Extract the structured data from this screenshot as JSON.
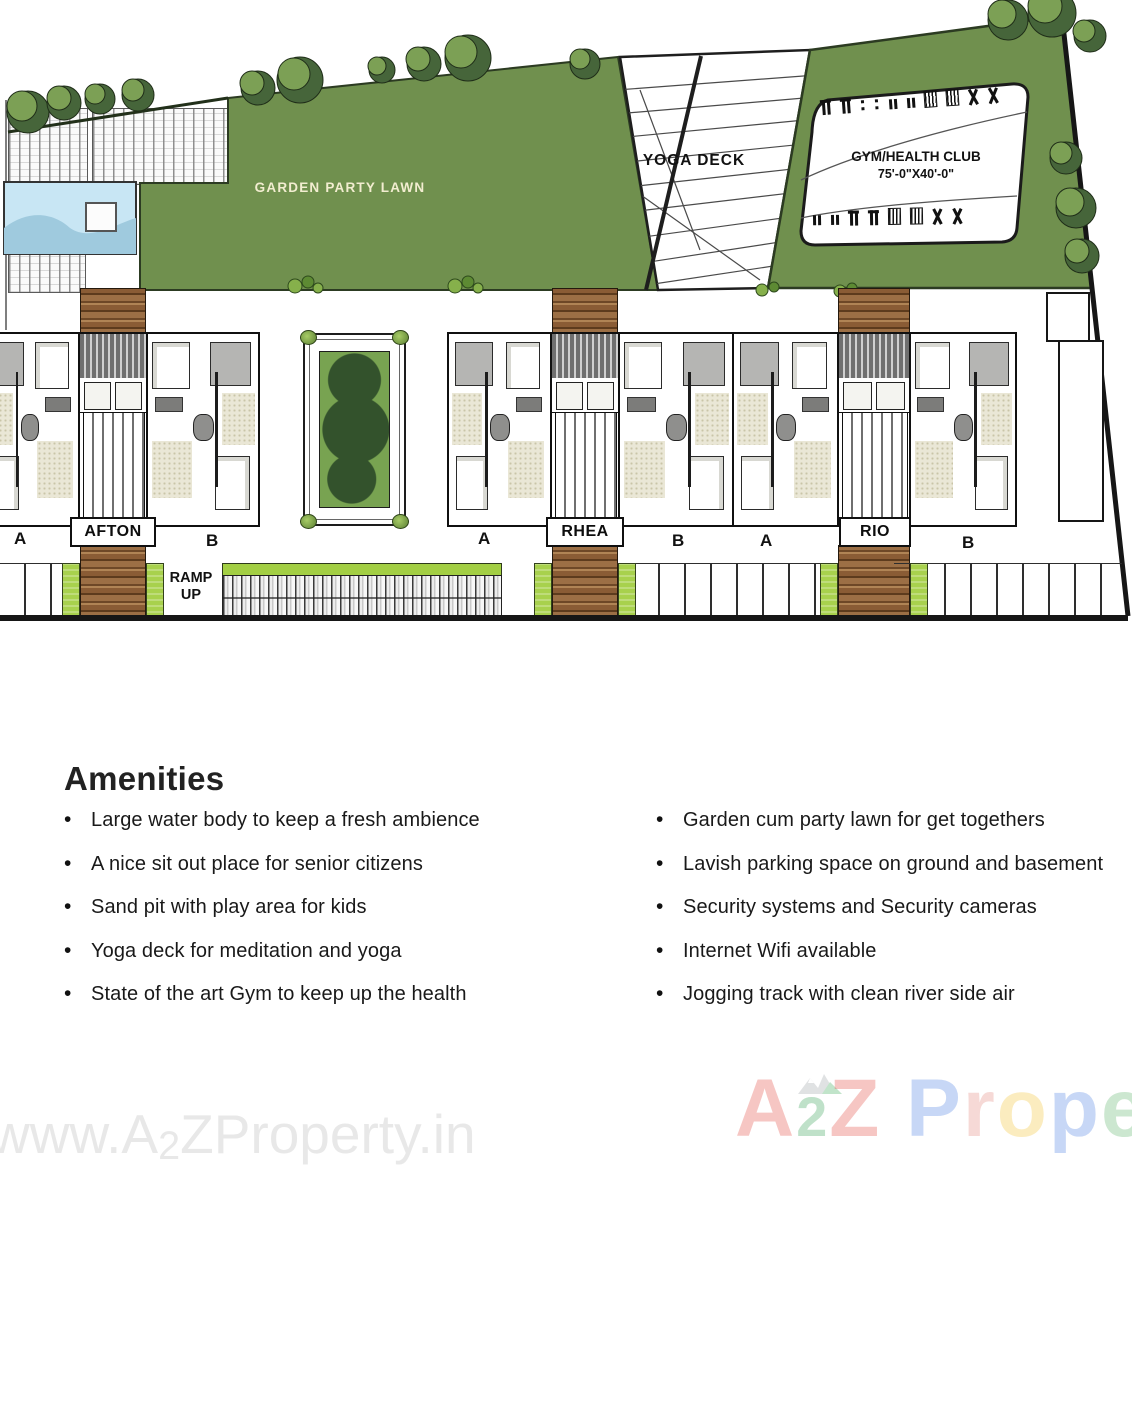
{
  "site_plan": {
    "garden_party_lawn_label": "GARDEN PARTY LAWN",
    "yoga_deck_label": "YOGA DECK",
    "gym_label_line1": "GYM/HEALTH CLUB",
    "gym_label_line2": "75'-0\"X40'-0\"",
    "ramp_label_line1": "RAMP",
    "ramp_label_line2": "UP",
    "buildings": [
      {
        "name": "AFTON",
        "left_unit": "A",
        "right_unit": "B"
      },
      {
        "name": "RHEA",
        "left_unit": "A",
        "right_unit": "B"
      },
      {
        "name": "RIO",
        "left_unit": "A",
        "right_unit": "B"
      }
    ],
    "features": [
      "swimming-pool",
      "sun-deck-loungers",
      "garden-party-lawn",
      "yoga-deck",
      "gym-health-club",
      "central-courtyard-garden",
      "wooden-walkways",
      "parking-stalls",
      "ramp-up"
    ],
    "colors": {
      "lawn": "#70904e",
      "tree_dark": "#46653a",
      "tree_light": "#7ca055",
      "pool_water": "#c8e6f4",
      "walkway_brown": "#8a5c35",
      "green_strip": "#a8d14d",
      "lawn_label_text": "#f2edd0"
    }
  },
  "amenities": {
    "title": "Amenities",
    "left": [
      "Large water body to keep a fresh ambience",
      "A nice sit out place for senior citizens",
      "Sand pit with play area for kids",
      "Yoga deck for meditation and yoga",
      "State of the art Gym to keep up the health"
    ],
    "right": [
      "Garden cum party lawn for get togethers",
      "Lavish parking space on ground and basement",
      "Security systems and Security cameras",
      "Internet Wifi available",
      "Jogging track with clean river side air"
    ]
  },
  "watermarks": {
    "left": {
      "prefix": "www.A",
      "sub": "2",
      "suffix": "ZProperty.in",
      "color": "#e8e8e8"
    },
    "right": {
      "letters": [
        {
          "ch": "A",
          "color": "#e2453c"
        },
        {
          "ch": "2",
          "color": "#2f9e4f",
          "small": true
        },
        {
          "ch": "Z",
          "color": "#e2453c"
        },
        {
          "ch": " "
        },
        {
          "ch": "P",
          "color": "#4a7de2"
        },
        {
          "ch": "r",
          "color": "#e2857a"
        },
        {
          "ch": "o",
          "color": "#f2c12e"
        },
        {
          "ch": "p",
          "color": "#4a7de2"
        },
        {
          "ch": "e",
          "color": "#58b368"
        }
      ]
    }
  }
}
